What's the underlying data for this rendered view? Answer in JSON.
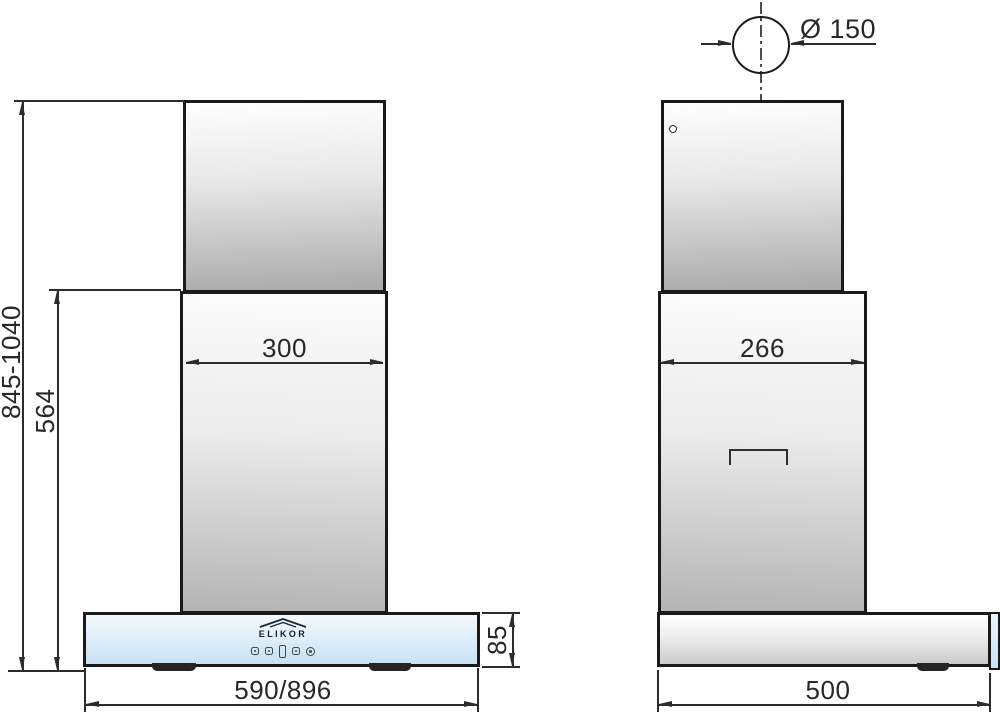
{
  "brand": {
    "logo_text": "ELIKOR"
  },
  "colors": {
    "outline": "#1a1a1a",
    "dimension_line": "#2c2c2c",
    "glass_blue_top": "#eef6fc",
    "glass_blue_bottom": "#c8e1f3",
    "metal_light": "#fefefe",
    "metal_dark": "#aaaaaa"
  },
  "front_view": {
    "dim_overall_height": "845-1040",
    "dim_telescope_height": "564",
    "dim_chimney_width": "300",
    "dim_body_width": "590/896",
    "dim_body_height": "85"
  },
  "side_view": {
    "dim_duct_diameter": "Ø 150",
    "dim_chimney_depth": "266",
    "dim_body_depth": "500"
  }
}
